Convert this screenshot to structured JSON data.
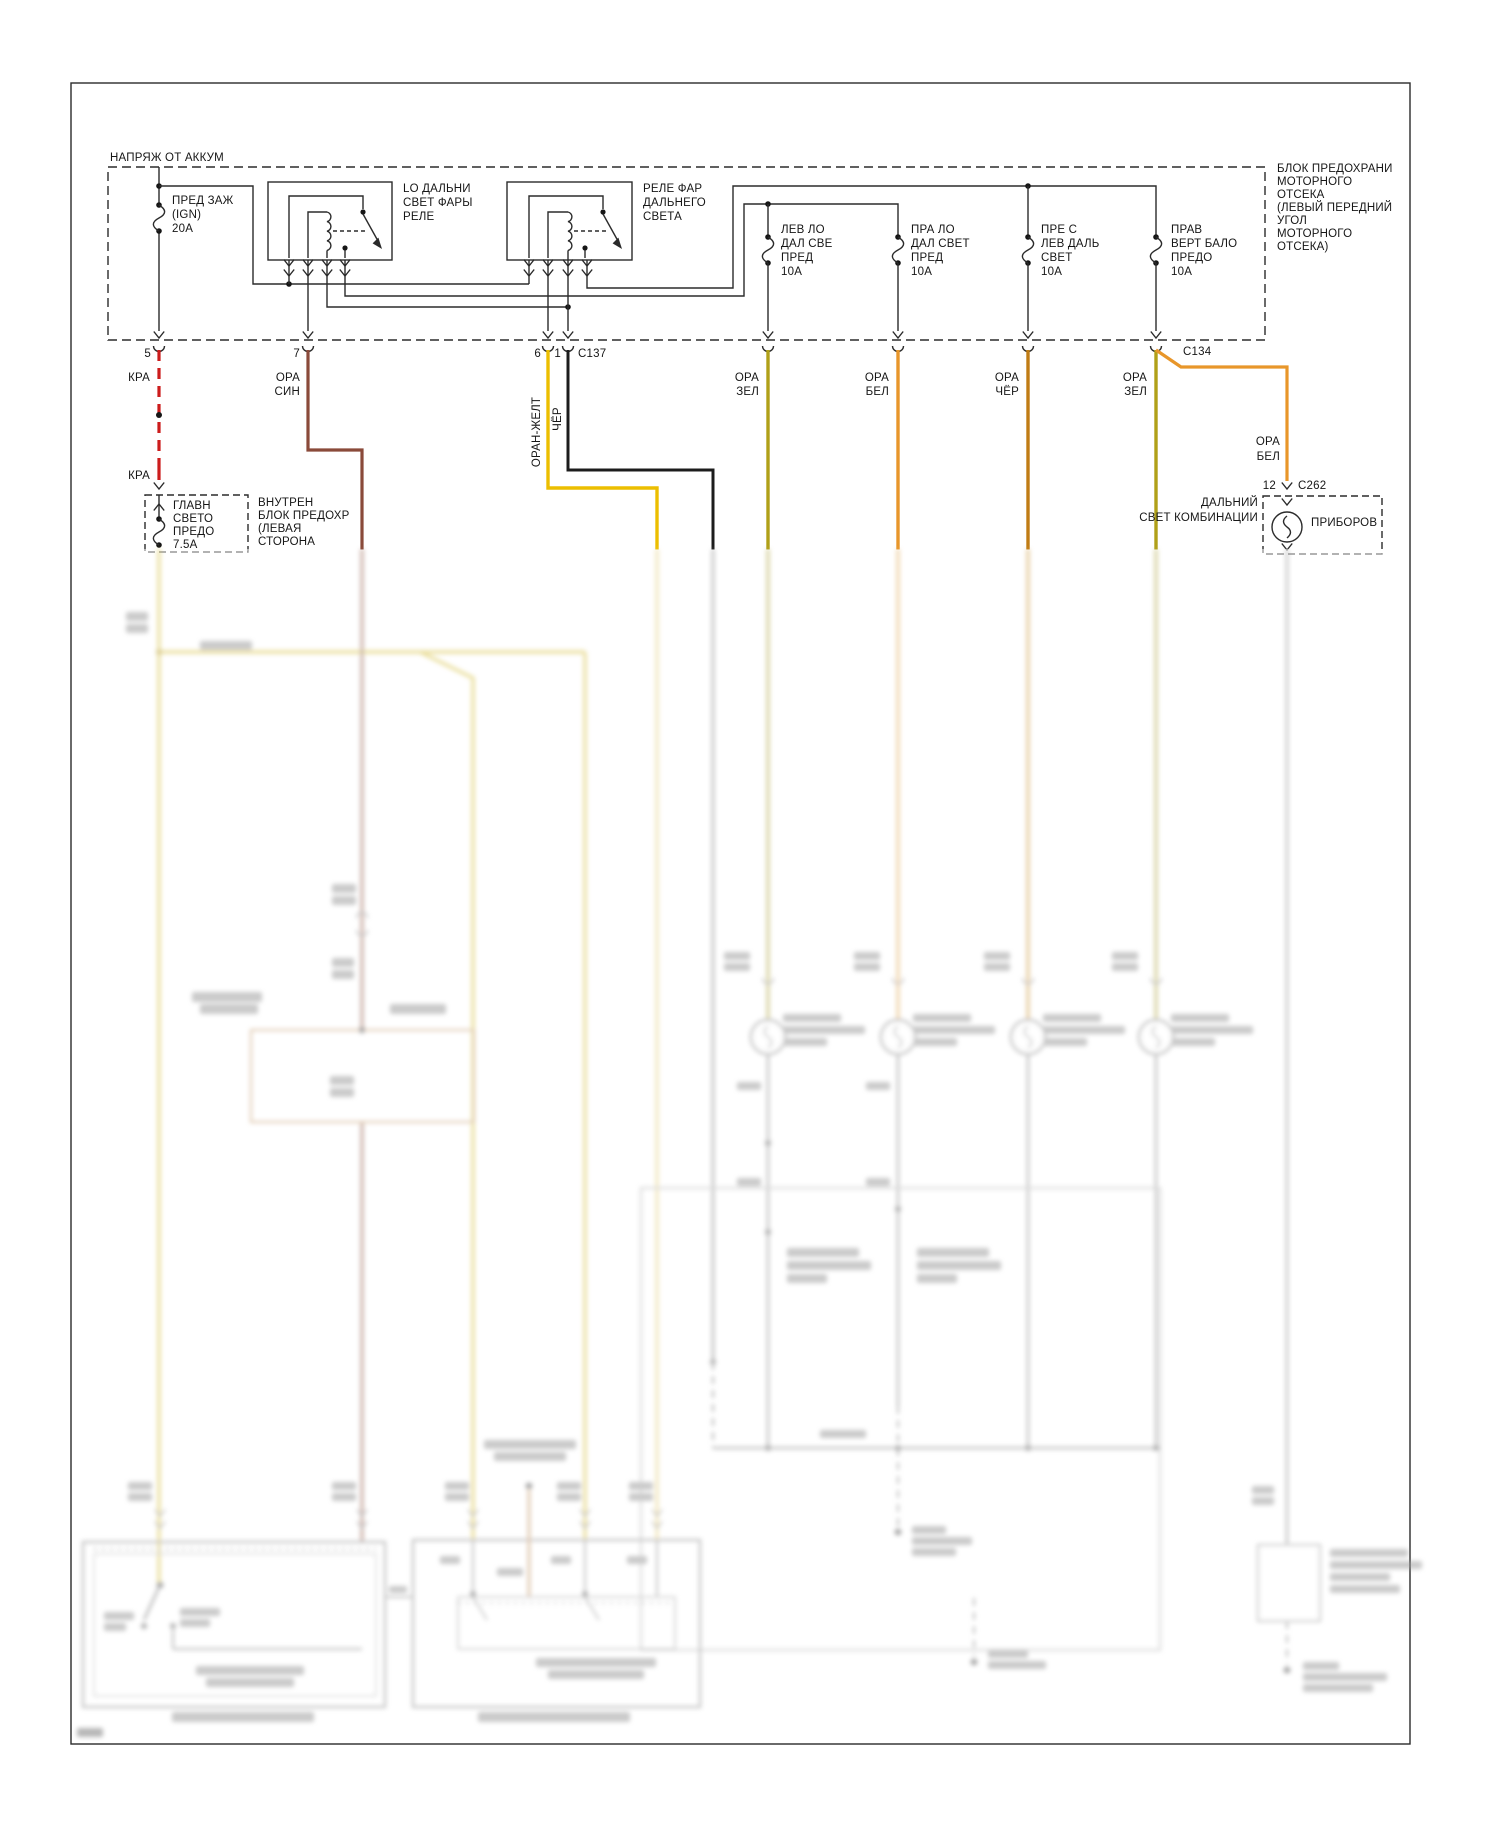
{
  "battery_box_label": "НАПРЯЖ ОТ АККУМ",
  "engine_fuse_block": [
    "БЛОК ПРЕДОХРАНИ",
    "МОТОРНОГО",
    "ОТСЕКА",
    "(ЛЕВЫЙ ПЕРЕДНИЙ",
    "УГОЛ",
    "МОТОРНОГО",
    "ОТСЕКА)"
  ],
  "ignition_fuse": [
    "ПРЕД ЗАЖ",
    "(IGN)",
    "20А"
  ],
  "low_beam_relay": [
    "LO ДАЛЬНИ",
    "СВЕТ ФАРЫ",
    "РЕЛЕ"
  ],
  "high_beam_relay": [
    "РЕЛЕ ФАР",
    "ДАЛЬНЕГО",
    "СВЕТА"
  ],
  "fuses": {
    "left_low": [
      "ЛЕВ ЛО",
      "ДАЛ СВЕ",
      "ПРЕД",
      "10А"
    ],
    "right_low": [
      "ПРА ЛО",
      "ДАЛ СВЕТ",
      "ПРЕД",
      "10А"
    ],
    "left_high": [
      "ПРЕ С",
      "ЛЕВ ДАЛЬ",
      "СВЕТ",
      "10А"
    ],
    "right_high": [
      "ПРАВ",
      "ВЕРТ БАЛО",
      "ПРЕДО",
      "10А"
    ]
  },
  "connectors": {
    "pin5": "5",
    "pin7": "7",
    "pin6": "6",
    "pin1": "1",
    "c137": "C137",
    "c134": "C134",
    "pin12": "12",
    "c262": "C262"
  },
  "wires": {
    "kra": "КРА",
    "kra2": "КРА",
    "ora_sin": [
      "ОРА",
      "СИН"
    ],
    "oran_zhelt": "ОРАН-ЖЕЛТ",
    "cher": "ЧЁР",
    "ora_zel": [
      "ОРА",
      "ЗЕЛ"
    ],
    "ora_bel": [
      "ОРА",
      "БЕЛ"
    ],
    "ora_cher": [
      "ОРА",
      "ЧЁР"
    ],
    "ora_zel2": [
      "ОРА",
      "ЗЕЛ"
    ],
    "ora_bel2": [
      "ОРА",
      "БЕЛ"
    ]
  },
  "main_light_fuse": [
    "ГЛАВН",
    "СВЕТО",
    "ПРЕДО",
    "7.5А"
  ],
  "interior_fuse_block": [
    "ВНУТРЕН",
    "БЛОК ПРЕДОХР",
    "(ЛЕВАЯ",
    "СТОРОНА"
  ],
  "cluster": {
    "label": "ПРИБОРОВ",
    "indicator_line1": "ДАЛЬНИЙ",
    "indicator_line2": "СВЕТ КОМБИНАЦИИ"
  },
  "colors": {
    "red": "#cc1c1c",
    "maroon": "#8a4a3a",
    "yellow": "#ecbe00",
    "black_wire": "#1c1c1c",
    "olive": "#b0a018",
    "orange": "#e8962a",
    "dark_orange": "#c07c14",
    "line": "#2b2b2b"
  }
}
